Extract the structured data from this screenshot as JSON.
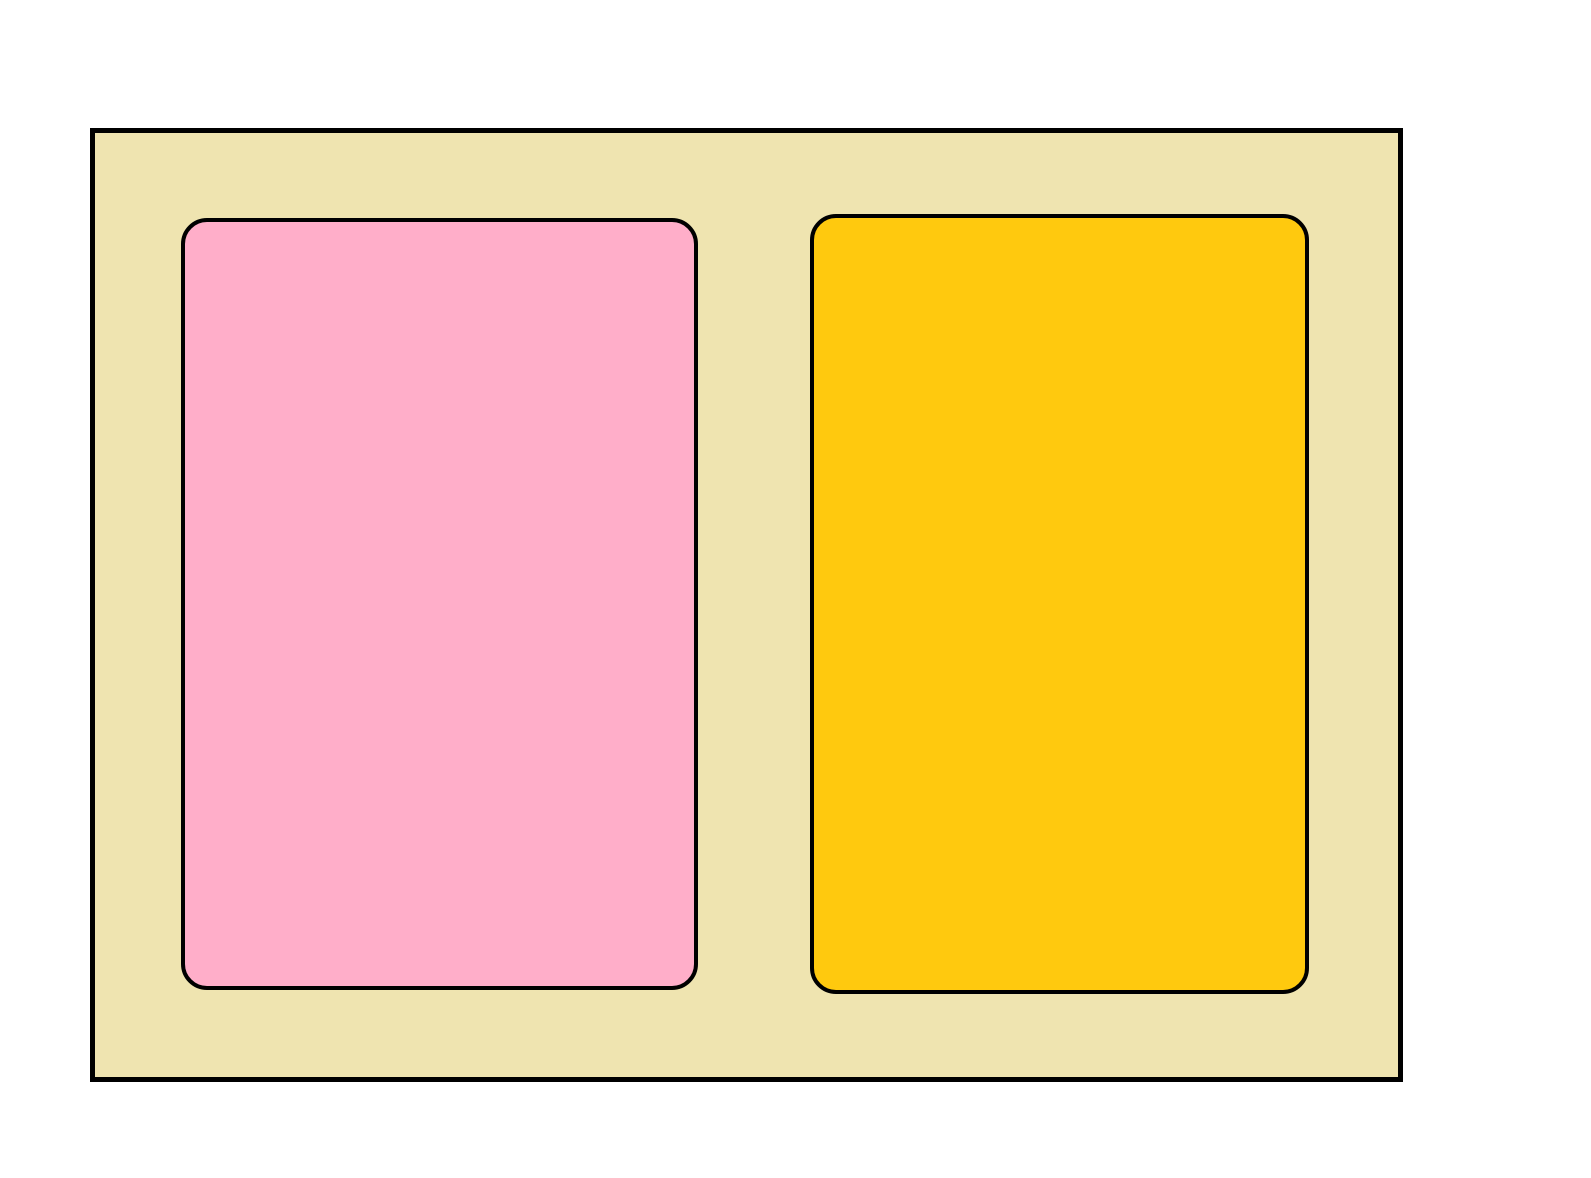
{
  "canvas": {
    "width_px": 1591,
    "height_px": 1178,
    "background_color": "#FFFFFF"
  },
  "shapes": {
    "outer_panel": {
      "name": "beige outer rectangle",
      "fill": "#EFE4B0",
      "stroke": "#000000",
      "stroke_width_px": 5
    },
    "left_card": {
      "name": "pink rounded rectangle",
      "fill": "#FFAEC9",
      "stroke": "#000000",
      "stroke_width_px": 4
    },
    "right_card": {
      "name": "yellow rounded rectangle",
      "fill": "#FFC90E",
      "stroke": "#000000",
      "stroke_width_px": 4
    }
  }
}
